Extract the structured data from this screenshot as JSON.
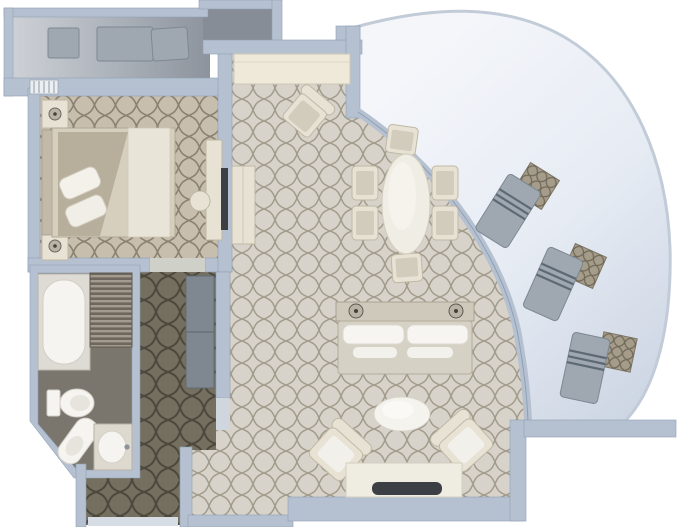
{
  "title": "suite-floor-plan",
  "palette": {
    "background": "#ffffff",
    "wall": "#b5c1d1",
    "wall_edge": "#8fa0b4",
    "carpet_living": "#d7d3ca",
    "carpet_living_pattern": "#a29b8c",
    "carpet_bedroom": "#c7beae",
    "carpet_bedroom_pattern": "#8b8170",
    "carpet_hall": "#756f60",
    "carpet_hall_pattern": "#4d483c",
    "bathroom_floor": "#7b766d",
    "deck_light": "#c6cacf",
    "deck_dark": "#878d96",
    "veranda_light": "#f2f4f9",
    "veranda_deep": "#ccd5e3",
    "veranda_rim": "#c2cbd8",
    "cream": "#e7e2d4",
    "cream_edge": "#bfb8a5",
    "white_fixture": "#f5f4f0",
    "lounger": "#9fa8b0",
    "lounger_edge": "#7c8893",
    "lounger_stripe": "#5d6974",
    "rattan": "#a59c8a",
    "rattan_pattern": "#6f6757",
    "tv_dark": "#3c3f43",
    "lamp": "#b9b3a6",
    "lamp_dot": "#44413a",
    "wardrobe": "#7f8890",
    "louver_light": "#a39b8f",
    "louver_dark": "#6e675d",
    "bed_duvet": "#d7cfbe",
    "bed_fold": "#e9e4d8",
    "bed_throw": "#b4aa97",
    "headboard": "#c2b9a8",
    "desk_top": "#efe9da",
    "table_top": "#f0ede4"
  },
  "plan": {
    "rooms": [
      {
        "name": "forward-veranda",
        "furniture": [
          "side-table",
          "sun-lounger"
        ]
      },
      {
        "name": "bedroom",
        "furniture": [
          "nightstand",
          "table-lamp",
          "double-bed",
          "pillows",
          "vanity-desk",
          "vanity-stool",
          "wall-tv"
        ]
      },
      {
        "name": "bathroom",
        "furniture": [
          "bathtub",
          "louver-closet",
          "toilet",
          "bidet",
          "sink-vanity"
        ]
      },
      {
        "name": "hallway-entry",
        "furniture": [
          "wardrobe",
          "threshold"
        ]
      },
      {
        "name": "living-dining-room",
        "furniture": [
          "writing-desk",
          "desk-chair",
          "dining-table",
          "dining-chairs-x6",
          "side-cabinet",
          "sofa",
          "console-lamps-x2",
          "coffee-table",
          "armchairs-x2",
          "tv-credenza",
          "tv"
        ]
      },
      {
        "name": "curved-veranda",
        "furniture": [
          "sun-lounger-x3",
          "rattan-table-x3"
        ]
      }
    ],
    "dining_chair_count": 6,
    "curved_veranda_lounger_count": 3
  }
}
